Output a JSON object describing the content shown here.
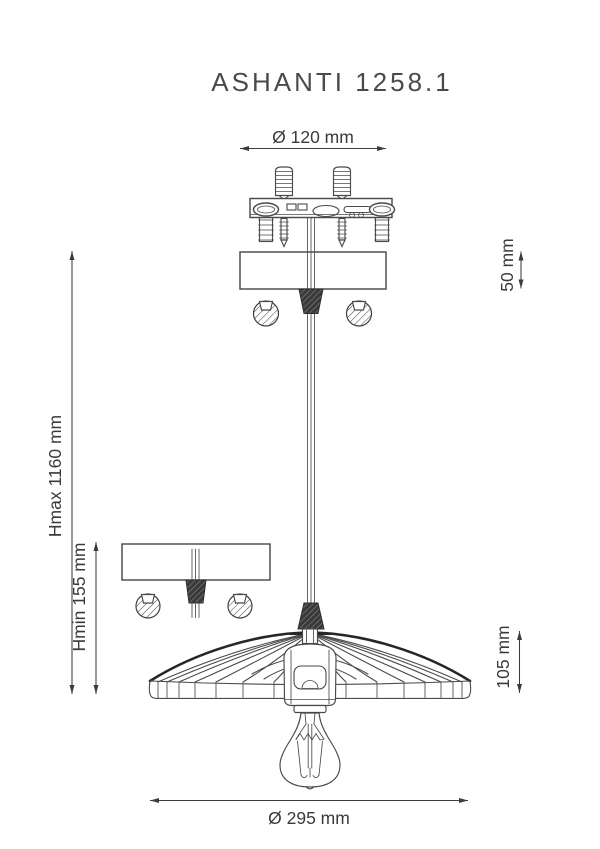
{
  "title": "ASHANTI 1258.1",
  "dimensions": {
    "mount_diameter": {
      "label": "Ø 120 mm"
    },
    "canopy_height": {
      "label": "50 mm"
    },
    "height_max": {
      "label": "Hmax 1160 mm"
    },
    "height_min": {
      "label": "Hmin 155 mm"
    },
    "shade_height": {
      "label": "105 mm"
    },
    "shade_diameter": {
      "label": "Ø 295 mm"
    }
  },
  "colors": {
    "background": "#ffffff",
    "line": "#4a4a4a",
    "line_dark": "#262626",
    "text": "#3a3a3a"
  }
}
